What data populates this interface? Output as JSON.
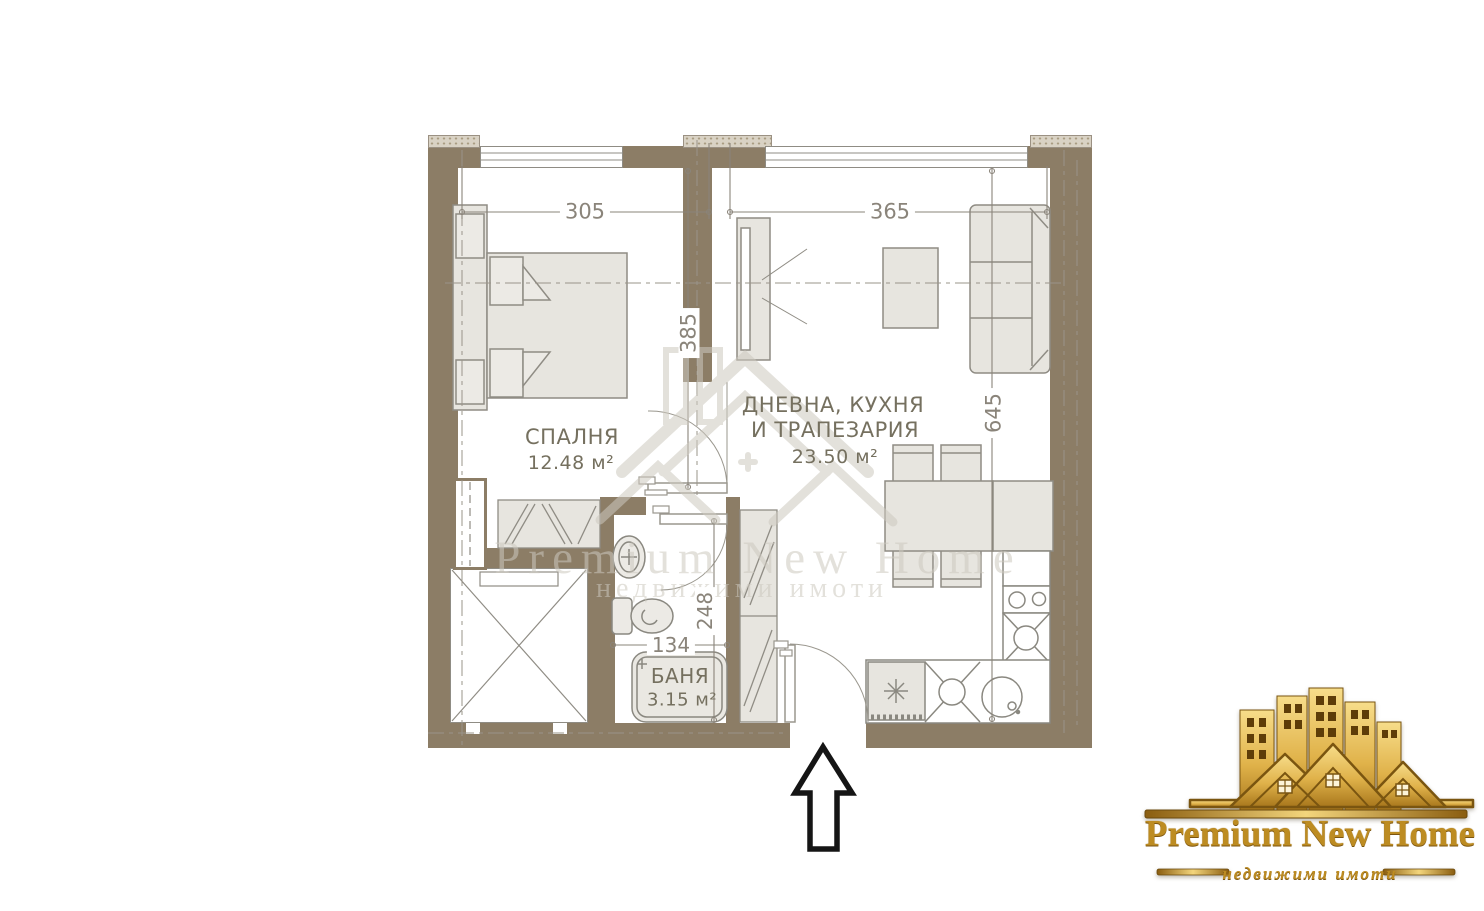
{
  "plan": {
    "colors": {
      "wall": "#8c7d66",
      "furniture_fill": "#e7e5df",
      "furniture_line": "#8f8c84",
      "dim_text": "#8a847a",
      "label_text": "#75705f",
      "watermark": "#cdc9bf",
      "logo_gold": "#bd8c22"
    },
    "labels": {
      "bedroom_name": "СПАЛНЯ",
      "bedroom_area": "12.48 м²",
      "living_name_line1": "ДНЕВНА, КУХНЯ",
      "living_name_line2": "И ТРАПЕЗАРИЯ",
      "living_area": "23.50 м²",
      "bath_name": "БАНЯ",
      "bath_area": "3.15 м²"
    },
    "dimensions": {
      "bedroom_width": "305",
      "living_width": "365",
      "bedroom_height": "385",
      "living_height": "645",
      "bath_width": "134",
      "bath_height": "248"
    }
  },
  "watermark": {
    "line1": "Premium New Home",
    "line2": "недвижими имоти"
  },
  "logo": {
    "title": "Premium New Home",
    "subtitle": "недвижими имоти"
  }
}
